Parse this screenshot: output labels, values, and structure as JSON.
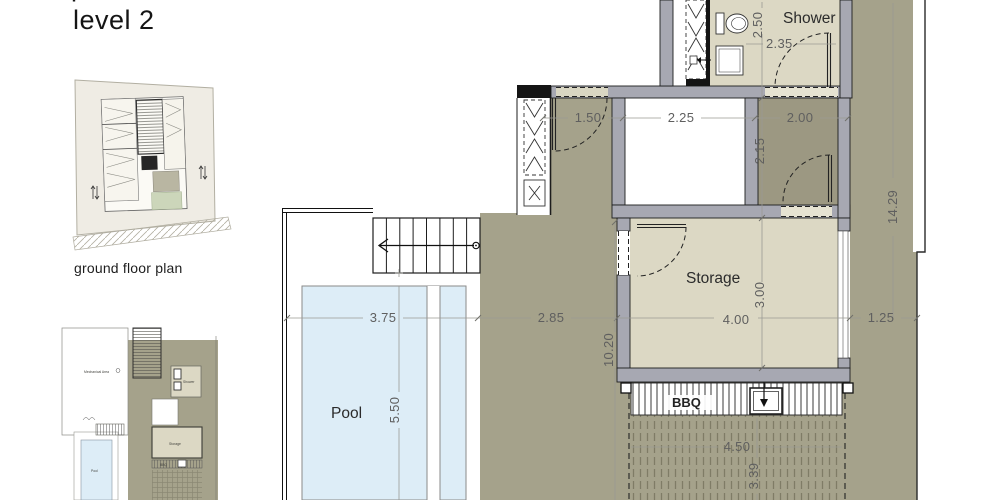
{
  "page": {
    "title": "level 2",
    "title_partial": "p"
  },
  "ground_floor_thumbnail": {
    "caption": "ground floor plan"
  },
  "level2_thumbnail": {
    "labels": {
      "mechanical_area": "Mechanical Area",
      "shower": "Shower",
      "storage": "Storage",
      "pool": "Pool",
      "bbq": "BBQ"
    }
  },
  "plan": {
    "room_labels": {
      "shower": "Shower",
      "storage": "Storage",
      "pool": "Pool",
      "bbq": "BBQ"
    },
    "dimensions": {
      "shower_width": "2.50",
      "shower_depth": "2.35",
      "opening_left": "1.50",
      "void_width": "2.25",
      "corridor_width": "2.00",
      "corridor_depth": "2.15",
      "site_height": "14.29",
      "storage_depth": "3.00",
      "storage_width": "4.00",
      "right_margin": "1.25",
      "pool_width": "3.75",
      "deck_width": "2.85",
      "terrace_length": "10.20",
      "pool_length": "5.50",
      "pergola_width": "4.50",
      "pergola_depth": "3.39"
    }
  },
  "colors": {
    "terrace_olive": "#a5a28b",
    "corridor_olive": "#9c9882",
    "room_beige": "#dcd8c4",
    "wall_gray": "#a7a8b2",
    "wall_outline": "#1d1d1d",
    "pool_blue": "#ddedf7",
    "pergola_hatch": "#85826c",
    "dim_text": "#5f5f5f",
    "mini_green": "#ccd6ba",
    "thumb_paper": "#efece4"
  }
}
